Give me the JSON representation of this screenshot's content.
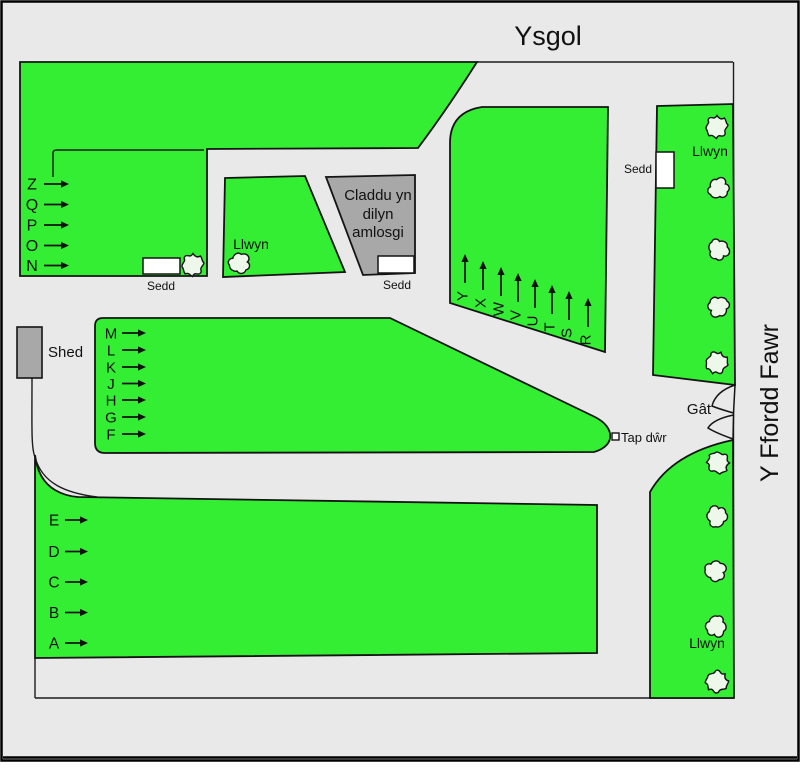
{
  "title": "Ysgol",
  "road_name": "Y Ffordd Fawr",
  "colors": {
    "grass": "#33ee33",
    "road_bg": "#e9e9e9",
    "building": "#a8a8a8",
    "bush": "#edf8eb",
    "outline": "#141414"
  },
  "cremation": {
    "lines": [
      "Claddu yn",
      "dilyn",
      "amlosgi"
    ]
  },
  "labels": {
    "shed": "Shed",
    "gate": "Gât",
    "water_tap": "Tap dŵr",
    "seat_north": "Sedd",
    "seat_cremation": "Sedd",
    "seat_east": "Sedd",
    "llwyn_mid": "Llwyn",
    "llwyn_ne": "Llwyn",
    "llwyn_se": "Llwyn"
  },
  "sections": {
    "north": {
      "rows": [
        "Z",
        "Q",
        "P",
        "O",
        "N"
      ]
    },
    "middle": {
      "rows": [
        "M",
        "L",
        "K",
        "J",
        "H",
        "G",
        "F"
      ]
    },
    "south": {
      "rows": [
        "E",
        "D",
        "C",
        "B",
        "A"
      ]
    },
    "east": {
      "rows": [
        "Y",
        "X",
        "W",
        "V",
        "U",
        "T",
        "S",
        "R"
      ]
    }
  }
}
